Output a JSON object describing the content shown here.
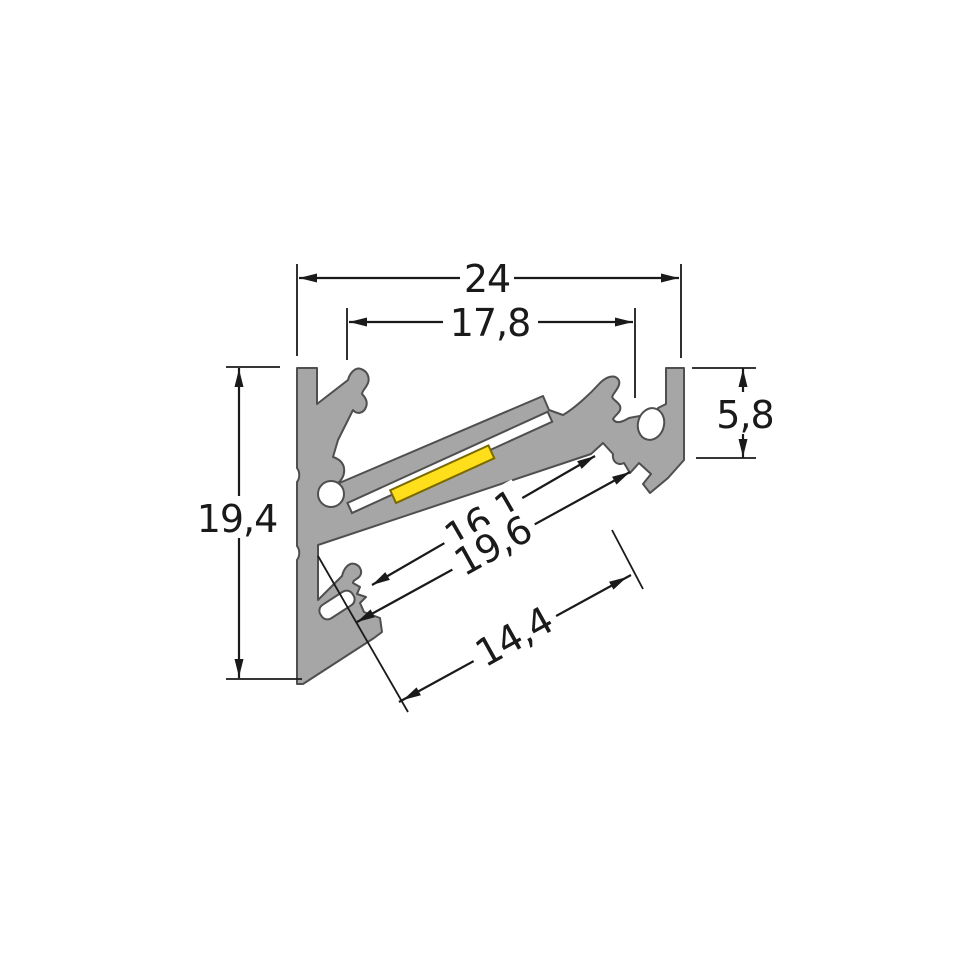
{
  "drawing": {
    "type": "technical-cross-section",
    "subject": "aluminium LED corner profile cross-section with LED strip",
    "units": "mm",
    "decimal_separator": ",",
    "dimensions": {
      "overall_width": {
        "label": "24",
        "orientation": "horizontal",
        "measures": "overall width across outer faces"
      },
      "inner_width_top": {
        "label": "17,8",
        "orientation": "horizontal",
        "measures": "spacing between spring clips"
      },
      "right_edge_depth": {
        "label": "5,8",
        "orientation": "vertical",
        "measures": "height of right retaining edge"
      },
      "overall_height": {
        "label": "19,4",
        "orientation": "vertical",
        "measures": "overall height of profile"
      },
      "channel_inner_width": {
        "label": "16,1",
        "orientation": "diagonal",
        "measures": "inner LED channel width"
      },
      "channel_outer_width": {
        "label": "19,6",
        "orientation": "diagonal",
        "measures": "outer channel width"
      },
      "opening_width": {
        "label": "14,4",
        "orientation": "diagonal",
        "measures": "light opening width"
      }
    },
    "parts": {
      "body": "extruded aluminium corner profile",
      "led_strip": "LED strip (yellow)",
      "carrier_plate": "LED carrier / cover plate (white)"
    },
    "colors": {
      "profile_fill": "#a6a6a6",
      "profile_outline": "#4f4f4f",
      "led_yellow": "#ffdf1b",
      "plate_white": "#ffffff",
      "dimension_color": "#1a1a1a",
      "background": "#ffffff"
    }
  }
}
